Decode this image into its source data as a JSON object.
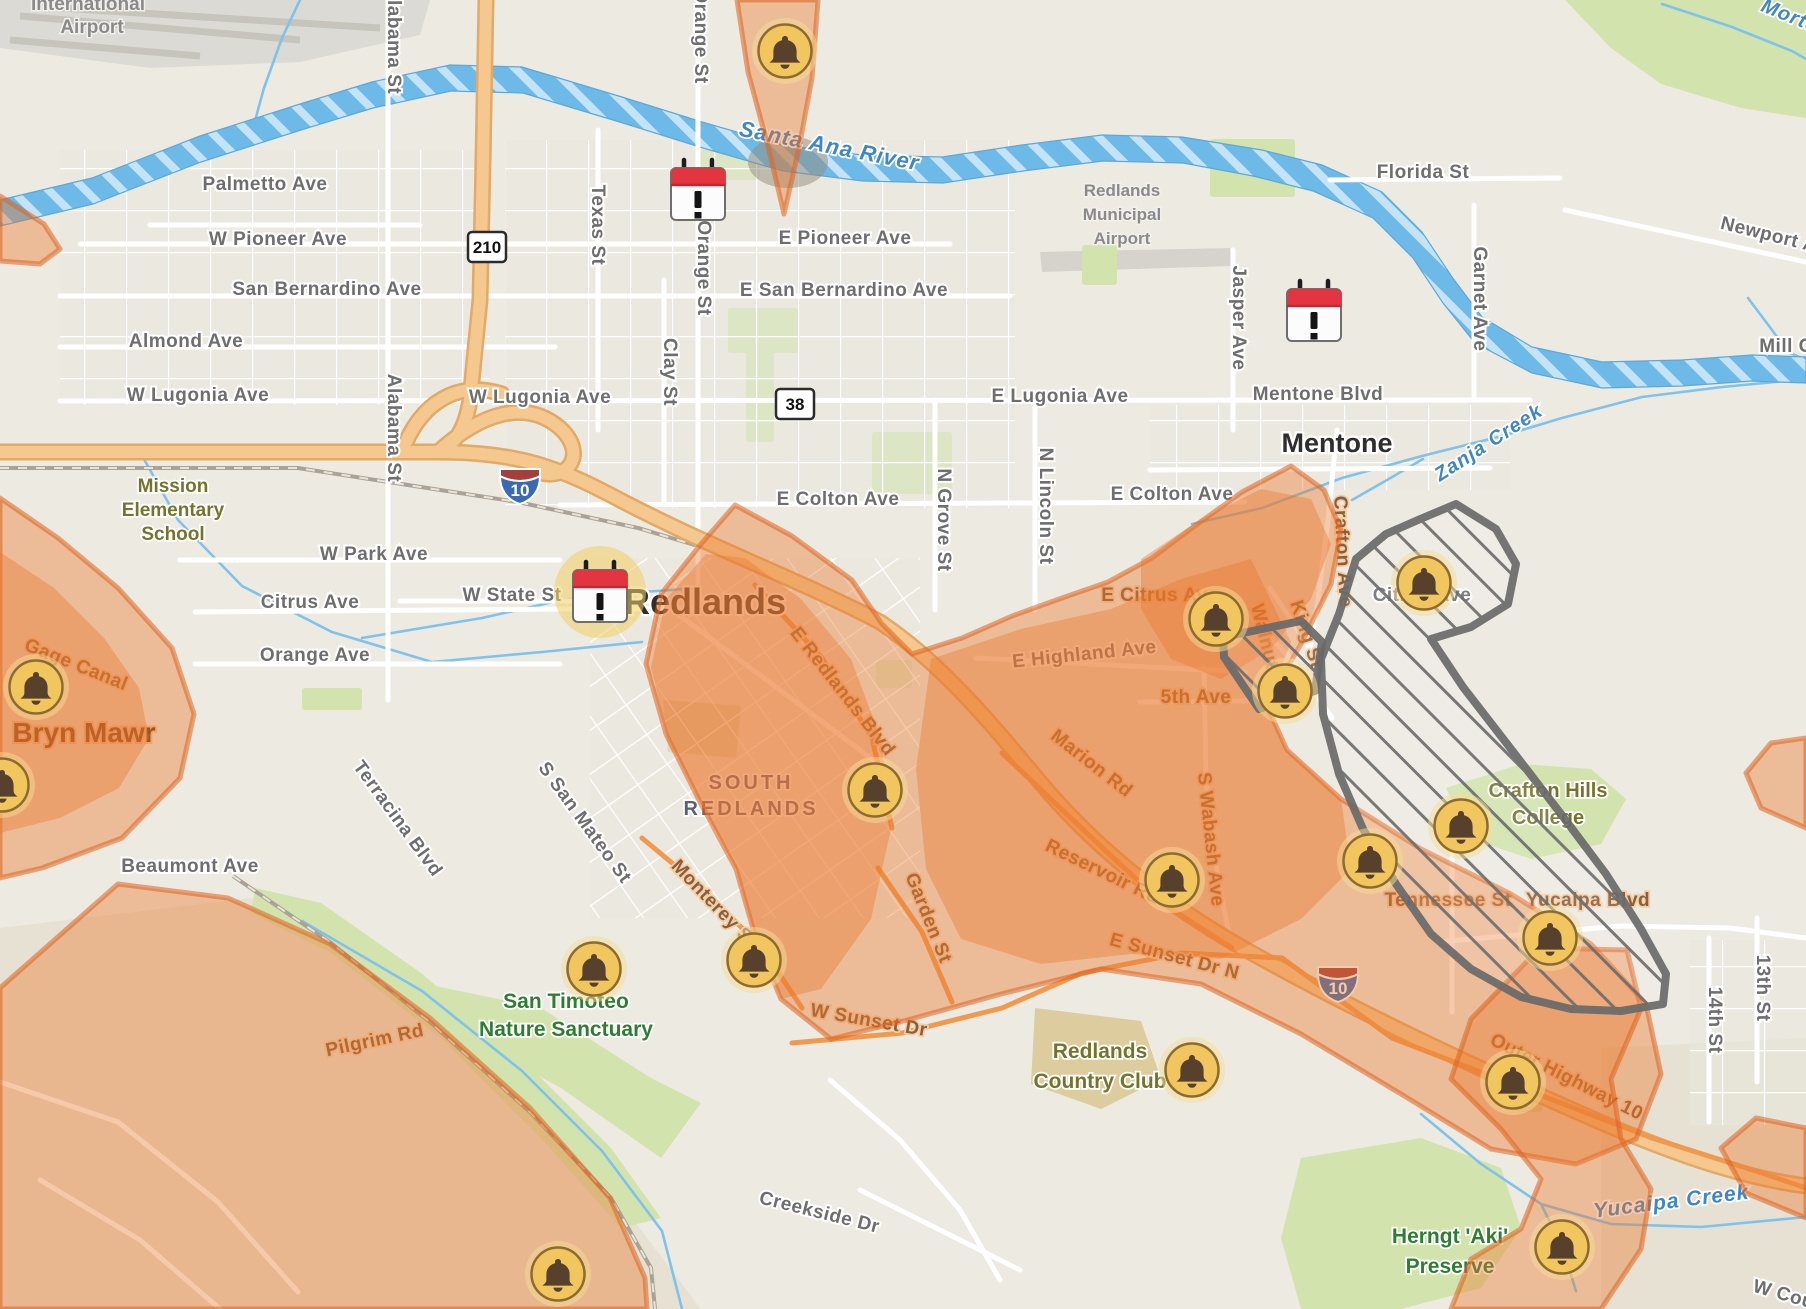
{
  "map": {
    "colors": {
      "land": "#edeae2",
      "hill": "#e6e1d3",
      "park": "#d2e3ae",
      "water": "#6db9e8",
      "road": "#ffffff",
      "highway_fill": "#f4c88f",
      "highway_edge": "#e2a967",
      "outage_fill": "rgba(235,119,46,0.40)",
      "outage_edge": "rgba(222,99,30,0.55)",
      "planned_edge": "#6a6a6a",
      "bell_fill": "#f1c65f",
      "bell_glyph": "#57402c",
      "calendar_red": "#e23540"
    },
    "icons": {
      "bells": [
        {
          "x": 785,
          "y": 51
        },
        {
          "x": 36,
          "y": 687
        },
        {
          "x": 2,
          "y": 785
        },
        {
          "x": 1216,
          "y": 619
        },
        {
          "x": 1285,
          "y": 691
        },
        {
          "x": 1424,
          "y": 583
        },
        {
          "x": 875,
          "y": 790
        },
        {
          "x": 594,
          "y": 969
        },
        {
          "x": 754,
          "y": 960
        },
        {
          "x": 1172,
          "y": 880
        },
        {
          "x": 1370,
          "y": 861
        },
        {
          "x": 1461,
          "y": 826
        },
        {
          "x": 1550,
          "y": 938
        },
        {
          "x": 1192,
          "y": 1070
        },
        {
          "x": 1513,
          "y": 1082
        },
        {
          "x": 1562,
          "y": 1247
        },
        {
          "x": 558,
          "y": 1274
        }
      ],
      "calendars": [
        {
          "x": 698,
          "y": 190,
          "halo": false
        },
        {
          "x": 1314,
          "y": 311,
          "halo": false
        },
        {
          "x": 600,
          "y": 592,
          "halo": true
        }
      ]
    },
    "shields": [
      {
        "kind": "rect",
        "label": "210",
        "x": 487,
        "y": 247
      },
      {
        "kind": "rect",
        "label": "38",
        "x": 795,
        "y": 404
      },
      {
        "kind": "interstate",
        "label": "10",
        "x": 520,
        "y": 487
      },
      {
        "kind": "interstate",
        "label": "10",
        "x": 1338,
        "y": 985
      }
    ],
    "labels": [
      {
        "t": "International",
        "x": 88,
        "y": 10,
        "c": "ai",
        "s": 19
      },
      {
        "t": "Airport",
        "x": 92,
        "y": 33,
        "c": "ai",
        "s": 19
      },
      {
        "t": "Palmetto Ave",
        "x": 265,
        "y": 190,
        "c": "st"
      },
      {
        "t": "W Pioneer Ave",
        "x": 278,
        "y": 245,
        "c": "st"
      },
      {
        "t": "E Pioneer Ave",
        "x": 845,
        "y": 244,
        "c": "st"
      },
      {
        "t": "San Bernardino Ave",
        "x": 327,
        "y": 295,
        "c": "st"
      },
      {
        "t": "E San Bernardino Ave",
        "x": 844,
        "y": 296,
        "c": "st"
      },
      {
        "t": "Almond Ave",
        "x": 186,
        "y": 347,
        "c": "st"
      },
      {
        "t": "W Lugonia Ave",
        "x": 198,
        "y": 401,
        "c": "st"
      },
      {
        "t": "W Lugonia Ave",
        "x": 540,
        "y": 403,
        "c": "st"
      },
      {
        "t": "E Lugonia Ave",
        "x": 1060,
        "y": 402,
        "c": "st"
      },
      {
        "t": "Mentone Blvd",
        "x": 1318,
        "y": 400,
        "c": "st"
      },
      {
        "t": "Florida St",
        "x": 1423,
        "y": 178,
        "c": "st"
      },
      {
        "t": "Garnet Ave",
        "x": 1474,
        "y": 299,
        "r": 90,
        "c": "st"
      },
      {
        "t": "Newport Ave",
        "x": 1778,
        "y": 243,
        "r": 14,
        "c": "st"
      },
      {
        "t": "Mill Cr",
        "x": 1790,
        "y": 352,
        "c": "st"
      },
      {
        "t": "Morto",
        "x": 1788,
        "y": 22,
        "r": 22,
        "c": "wa"
      },
      {
        "t": "Alabama St",
        "x": 388,
        "y": 40,
        "r": 90,
        "c": "st"
      },
      {
        "t": "Alabama St",
        "x": 388,
        "y": 428,
        "r": 90,
        "c": "st"
      },
      {
        "t": "Texas St",
        "x": 592,
        "y": 225,
        "r": 90,
        "c": "st"
      },
      {
        "t": "Clay St",
        "x": 664,
        "y": 372,
        "r": 90,
        "c": "st"
      },
      {
        "t": "Orange St",
        "x": 695,
        "y": 36,
        "r": 90,
        "c": "st"
      },
      {
        "t": "Orange St",
        "x": 698,
        "y": 268,
        "r": 90,
        "c": "st"
      },
      {
        "t": "Santa Ana River",
        "x": 828,
        "y": 153,
        "r": 11,
        "c": "wa",
        "s": 22
      },
      {
        "t": "Zanja Creek",
        "x": 1492,
        "y": 448,
        "r": -33,
        "c": "wa"
      },
      {
        "t": "Mission",
        "x": 173,
        "y": 492,
        "c": "po"
      },
      {
        "t": "Elementary",
        "x": 173,
        "y": 516,
        "c": "po"
      },
      {
        "t": "School",
        "x": 173,
        "y": 540,
        "c": "po"
      },
      {
        "t": "W Park Ave",
        "x": 374,
        "y": 560,
        "c": "st"
      },
      {
        "t": "Citrus Ave",
        "x": 310,
        "y": 608,
        "c": "st"
      },
      {
        "t": "Orange Ave",
        "x": 315,
        "y": 661,
        "c": "st"
      },
      {
        "t": "W State St",
        "x": 512,
        "y": 601,
        "c": "st"
      },
      {
        "t": "E Colton Ave",
        "x": 838,
        "y": 505,
        "c": "st"
      },
      {
        "t": "E Colton Ave",
        "x": 1172,
        "y": 500,
        "c": "st"
      },
      {
        "t": "N Grove St",
        "x": 938,
        "y": 520,
        "r": 90,
        "c": "st"
      },
      {
        "t": "N Lincoln St",
        "x": 1040,
        "y": 506,
        "r": 90,
        "c": "st"
      },
      {
        "t": "Jasper Ave",
        "x": 1233,
        "y": 318,
        "r": 90,
        "c": "st"
      },
      {
        "t": "E Citrus Ave",
        "x": 1160,
        "y": 601,
        "c": "so"
      },
      {
        "t": "E Highland Ave",
        "x": 1085,
        "y": 660,
        "r": -6,
        "c": "st"
      },
      {
        "t": "5th Ave",
        "x": 1196,
        "y": 703,
        "c": "so"
      },
      {
        "t": "Marion Rd",
        "x": 1088,
        "y": 768,
        "r": 38,
        "c": "so"
      },
      {
        "t": "Walnut St",
        "x": 1262,
        "y": 650,
        "r": 76,
        "c": "so"
      },
      {
        "t": "King St",
        "x": 1301,
        "y": 636,
        "r": 72,
        "c": "so"
      },
      {
        "t": "Crafton Ave",
        "x": 1337,
        "y": 552,
        "r": 87,
        "c": "so"
      },
      {
        "t": "Citrus Ave",
        "x": 1422,
        "y": 601,
        "c": "st"
      },
      {
        "t": "S Wabash Ave",
        "x": 1205,
        "y": 840,
        "r": 84,
        "c": "so"
      },
      {
        "t": "Tennessee St",
        "x": 1448,
        "y": 906,
        "c": "so"
      },
      {
        "t": "Yucaipa Blvd",
        "x": 1588,
        "y": 906,
        "c": "so"
      },
      {
        "t": "Reservoir Rd",
        "x": 1100,
        "y": 877,
        "r": 26,
        "c": "so"
      },
      {
        "t": "E Sunset Dr N",
        "x": 1173,
        "y": 962,
        "r": 15,
        "c": "so"
      },
      {
        "t": "W Sunset Dr",
        "x": 868,
        "y": 1026,
        "r": 10,
        "c": "so"
      },
      {
        "t": "Outer Highway 10",
        "x": 1564,
        "y": 1082,
        "r": 27,
        "c": "so"
      },
      {
        "t": "Monterey St",
        "x": 710,
        "y": 908,
        "r": 46,
        "c": "so"
      },
      {
        "t": "Garden St",
        "x": 923,
        "y": 920,
        "r": 68,
        "c": "so"
      },
      {
        "t": "E Redlands Blvd",
        "x": 838,
        "y": 695,
        "r": 52,
        "c": "so"
      },
      {
        "t": "S San Mateo St",
        "x": 580,
        "y": 826,
        "r": 54,
        "c": "st"
      },
      {
        "t": "Terracina Blvd",
        "x": 393,
        "y": 822,
        "r": 54,
        "c": "st"
      },
      {
        "t": "Beaumont Ave",
        "x": 190,
        "y": 872,
        "c": "st"
      },
      {
        "t": "Gage Canal",
        "x": 74,
        "y": 670,
        "r": 22,
        "c": "so"
      },
      {
        "t": "Pilgrim Rd",
        "x": 376,
        "y": 1046,
        "r": -12,
        "c": "so"
      },
      {
        "t": "Creekside Dr",
        "x": 818,
        "y": 1218,
        "r": 14,
        "c": "st"
      },
      {
        "t": "14th St",
        "x": 1709,
        "y": 1020,
        "r": 90,
        "c": "st"
      },
      {
        "t": "13th St",
        "x": 1757,
        "y": 988,
        "r": 90,
        "c": "st"
      },
      {
        "t": "W Cou",
        "x": 1782,
        "y": 1300,
        "r": 16,
        "c": "st"
      },
      {
        "t": "Yucaipa Creek",
        "x": 1672,
        "y": 1208,
        "r": -7,
        "c": "wa",
        "s": 21
      },
      {
        "t": "Mentone",
        "x": 1337,
        "y": 452,
        "c": "ci",
        "s": 27
      },
      {
        "t": "Redlands",
        "x": 705,
        "y": 614,
        "c": "ci",
        "s": 36
      },
      {
        "t": "Bryn Mawr",
        "x": 84,
        "y": 742,
        "c": "cio"
      },
      {
        "t": "SOUTH",
        "x": 751,
        "y": 789,
        "c": "pu"
      },
      {
        "t": "REDLANDS",
        "x": 751,
        "y": 815,
        "c": "pu"
      },
      {
        "t": "Redlands",
        "x": 1122,
        "y": 196,
        "c": "ai"
      },
      {
        "t": "Municipal",
        "x": 1122,
        "y": 220,
        "c": "ai"
      },
      {
        "t": "Airport",
        "x": 1122,
        "y": 244,
        "c": "ai"
      },
      {
        "t": "Crafton Hills",
        "x": 1548,
        "y": 797,
        "c": "po",
        "s": 20
      },
      {
        "t": "College",
        "x": 1548,
        "y": 824,
        "c": "po",
        "s": 20
      },
      {
        "t": "San Timoteo",
        "x": 566,
        "y": 1008,
        "c": "pg"
      },
      {
        "t": "Nature Sanctuary",
        "x": 566,
        "y": 1036,
        "c": "pg"
      },
      {
        "t": "Herngt 'Aki'",
        "x": 1450,
        "y": 1243,
        "c": "pg"
      },
      {
        "t": "Preserve",
        "x": 1450,
        "y": 1273,
        "c": "pg"
      },
      {
        "t": "Redlands",
        "x": 1100,
        "y": 1058,
        "c": "po",
        "s": 21
      },
      {
        "t": "Country Club",
        "x": 1100,
        "y": 1088,
        "c": "po",
        "s": 21
      },
      {
        "t": "SOUTH REDLANDS_marker_unused",
        "x": -999,
        "y": -999,
        "c": "st"
      }
    ],
    "zones": {
      "outage": [
        "737,0 818,0 812,78 799,148 784,214 769,150 748,72",
        "0,498 58,538 118,588 172,648 194,714 180,778 122,838 42,868 0,878",
        "118,884 228,898 330,944 430,1018 530,1108 610,1198 645,1278 647,1309 0,1309 0,988",
        "735,505 792,536 852,580 882,624 912,654 962,638 1012,616 1062,598 1108,582 1152,558 1192,528 1242,492 1291,466 1324,490 1341,530 1331,584 1301,644 1266,704 1287,750 1341,799 1421,849 1511,894 1591,944 1646,1004 1661,1074 1636,1139 1576,1164 1491,1149 1401,1094 1301,1034 1201,984 1101,969 1001,994 911,1019 831,1039 781,999 756,939 736,869 701,804 666,734 646,664 661,594 701,544",
        "1540,948 1627,950 1641,1009 1611,1079 1621,1139 1651,1189 1641,1249 1601,1309 1451,1309 1471,1259 1521,1229 1541,1179 1501,1129 1451,1079 1471,1019",
        "1806,738 1806,828 1761,808 1746,773 1771,743",
        "1806,1128 1806,1218 1746,1193 1721,1148 1756,1118",
        "0,196 44,224 60,249 40,264 0,261"
      ],
      "outage_inner": [
        "0,552 54,588 104,638 139,688 149,738 119,788 60,818 0,833",
        "745,558 801,599 851,659 881,739 891,829 871,919 821,989 781,999 756,939 736,869 701,804 668,737 651,667 666,599 706,554",
        "931,659 1021,629 1111,609 1181,579 1251,559 1291,642 1266,704 1287,750 1341,799 1351,869 1301,919 1221,959 1131,954 1041,964 961,939 926,869 916,769",
        "1141,559 1201,519 1261,489 1311,499 1331,544 1311,599 1271,649 1221,679 1171,659 1141,609"
      ],
      "planned": [
        "1223,637 1301,621 1322,642 1315,691 1259,709 1224,657",
        "1418,520 1456,504 1496,529 1516,564 1508,604 1471,627 1431,639 1463,687 1511,749 1561,814 1606,874 1641,929 1666,974 1663,1004 1621,1011 1571,1009 1521,997 1471,969 1431,934 1396,884 1363,829 1339,774 1323,714 1321,659 1339,614 1356,559 1386,534"
      ]
    },
    "basemap": {
      "hills": [
        "0,928 251,898 541,1098 701,1309 0,1309",
        "1601,1048 1806,1038 1806,1309 1601,1309"
      ],
      "airport_poly": "0,0 430,0 420,35 300,62 150,68 0,48",
      "runways": [
        "20,16 300,40",
        "10,40 200,56",
        "60,8 380,28"
      ],
      "muni_airport": "1040,252 1230,248 1232,266 1042,272",
      "parks": [
        "1565,0 1806,0 1806,118 1741,108 1661,84 1611,48",
        "1446,788 1521,764 1591,769 1626,799 1601,844 1531,859 1471,839",
        "1281,1238 1301,1158 1421,1138 1501,1168 1521,1228 1481,1288 1401,1309 1301,1309",
        "255,888 321,903 421,973 521,1058 611,1148 661,1218 621,1228 541,1138 441,1038 331,953 251,913",
        "421,983 541,1008 651,1078 701,1103 661,1158 561,1088 451,1028"
      ],
      "park_rects": [
        [
          728,
          308,
          70,
          45
        ],
        [
          746,
          352,
          28,
          90
        ],
        [
          872,
          432,
          80,
          62
        ],
        [
          700,
          150,
          60,
          30
        ],
        [
          1210,
          139,
          85,
          58
        ],
        [
          1082,
          245,
          35,
          40
        ],
        [
          876,
          660,
          36,
          28
        ],
        [
          302,
          688,
          60,
          22
        ],
        [
          1516,
          1090,
          26,
          22
        ]
      ],
      "golf": [
        "1035,1008 1141,1021 1161,1079 1101,1109 1031,1084",
        "663,700 741,706 736,758 668,752"
      ],
      "grids": [
        {
          "x": 505,
          "y": 140,
          "w": 510,
          "h": 368,
          "p": "gridA"
        },
        {
          "x": 1150,
          "y": 405,
          "w": 360,
          "h": 85,
          "p": "gridA"
        },
        {
          "x": 60,
          "y": 150,
          "w": 430,
          "h": 255,
          "p": "gridA"
        },
        {
          "x": 590,
          "y": 558,
          "w": 330,
          "h": 360,
          "p": "gridB"
        },
        {
          "x": 1690,
          "y": 940,
          "w": 116,
          "h": 185,
          "p": "gridA"
        }
      ],
      "river_band": "0,200 92,178 200,136 300,104 372,82 450,65 522,67 562,79 622,97 702,122 782,145 862,155 942,157 1022,145 1102,135 1182,137 1262,150 1322,165 1382,192 1422,232 1452,277 1482,317 1532,347 1602,362 1682,360 1752,355 1806,357 1806,383 1752,381 1682,386 1602,388 1532,373 1475,343 1443,303 1413,258 1373,218 1313,191 1253,176 1183,163 1103,161 1023,171 943,183 863,181 783,171 703,148 623,123 563,105 523,93 451,91 373,108 301,130 201,162 93,204 0,226",
      "creeks": [
        "300,0 282,38 264,88 253,128",
        "140,452 178,520 242,586 332,632 432,662 542,652 642,642",
        "362,638 482,618 562,600 642,592 700,588",
        "1192,524 1262,508 1342,478 1422,456 1502,436 1562,418 1642,397 1722,387 1806,379",
        "1423,459 1387,480 1352,500",
        "302,921 422,991 522,1071 602,1151 662,1231 682,1309",
        "1421,1114 1481,1164 1541,1204 1611,1224 1701,1227 1806,1217",
        "1542,1206 1562,1246 1576,1291",
        "1662,4 1732,27 1792,51 1806,59",
        "1748,298 1772,330 1788,352 1806,360"
      ],
      "railroads": [
        "0,468 298,468 518,502 638,528 738,558 818,588 868,608",
        "233,876 331,943 431,1023 531,1113 611,1198 651,1268 655,1309"
      ],
      "roads": [
        "80,244 950,244",
        "60,296 1010,296",
        "60,347 555,347",
        "60,401 1530,400",
        "560,505 1245,502",
        "180,560 560,560",
        "195,612 700,608",
        "195,664 560,664",
        "400,601 660,601 780,690 900,780",
        "150,225 420,225",
        "388,0 388,700",
        "598,130 598,430",
        "664,280 664,505",
        "698,0 698,600",
        "935,400 935,610",
        "1035,400 1035,610",
        "1233,250 1233,430",
        "1474,205 1474,400",
        "1330,180 1560,178",
        "1565,210 1806,262",
        "975,658 1245,672",
        "1140,702 1310,700",
        "1337,430 1328,520 1318,600 1308,660",
        "1233,598 1292,660 1332,718",
        "1270,588 1312,652",
        "1204,668 1206,780 1218,880 1232,948",
        "1452,838 1452,1012",
        "1438,942 1620,926 1730,928 1806,938",
        "1709,938 1709,1122",
        "1757,918 1757,1082",
        "1150,470 1490,468",
        "0,1082 118,1122 218,1202 298,1292",
        "40,1180 140,1240 220,1309",
        "830,1080 900,1140 960,1210 1000,1280",
        "860,1190 940,1230 1020,1270"
      ],
      "orange_roads": [
        "1002,753 1092,838 1162,903 1232,948",
        "1392,1038 1522,1088 1652,1138 1762,1173 1806,1188",
        "792,1043 902,1033 1002,1008 1082,973 1182,953 1282,958 1392,1038",
        "878,868 922,932 952,1002",
        "642,838 702,888 762,948 802,1008",
        "755,585 822,658 872,738 892,828"
      ],
      "highways": [
        "M0,452 L438,452 C520,452 560,468 620,500 C720,552 800,580 880,622 C940,662 990,722 1040,782 C1090,842 1160,902 1250,952 C1340,1002 1440,1052 1600,1122 C1700,1165 1760,1180 1806,1186",
        "M486,0 L483,160 L480,300 L470,400 C465,430 455,444 438,452",
        "M438,452 C480,414 525,398 560,428 C588,454 568,482 538,472",
        "M402,452 C420,402 458,380 502,394"
      ],
      "river_shadow": {
        "x": 788,
        "y": 162,
        "rx": 40,
        "ry": 26
      }
    }
  }
}
